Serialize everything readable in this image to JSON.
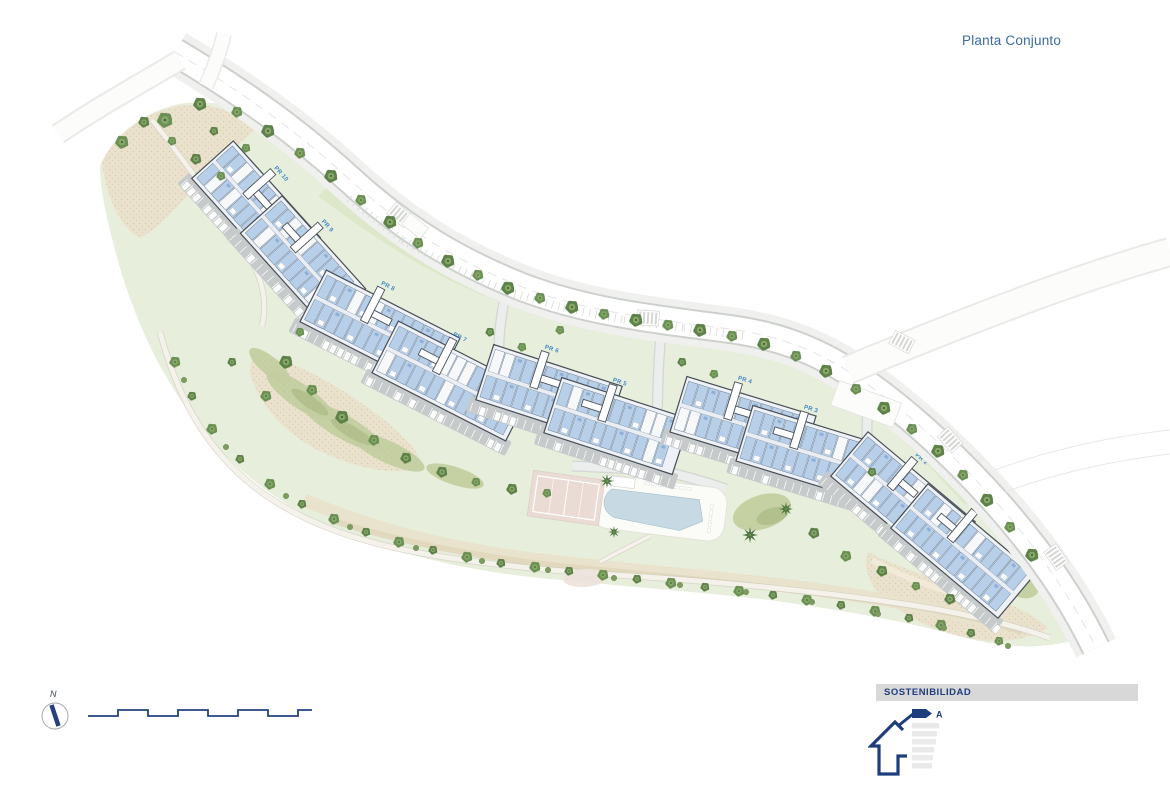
{
  "sheet": {
    "title": "Planta Conjunto"
  },
  "plan": {
    "portal_labels": [
      "PR 10",
      "PR 9",
      "PR 8",
      "PR 7",
      "PR 6",
      "PR 5",
      "PR 4",
      "PR 3",
      "PR 2",
      "PR 1"
    ],
    "features": [
      "perimeter-road",
      "street-parking",
      "apartment-blocks",
      "entrance-portals",
      "communal-pool",
      "pool-deck",
      "paddle-court",
      "gardens",
      "walking-paths",
      "trees"
    ]
  },
  "compass": {
    "label": "N"
  },
  "sustainability": {
    "heading": "SOSTENIBILIDAD",
    "energy_rating": "A"
  },
  "colors": {
    "accent_blue": "#3a6ca4",
    "navy": "#24407e",
    "building_unit": "#b7cfe9",
    "terrain_green": "#e7eedb",
    "tree_green": "#5f8049",
    "pool_blue": "#c7dae3",
    "banner_gray": "#d8d8d8"
  }
}
